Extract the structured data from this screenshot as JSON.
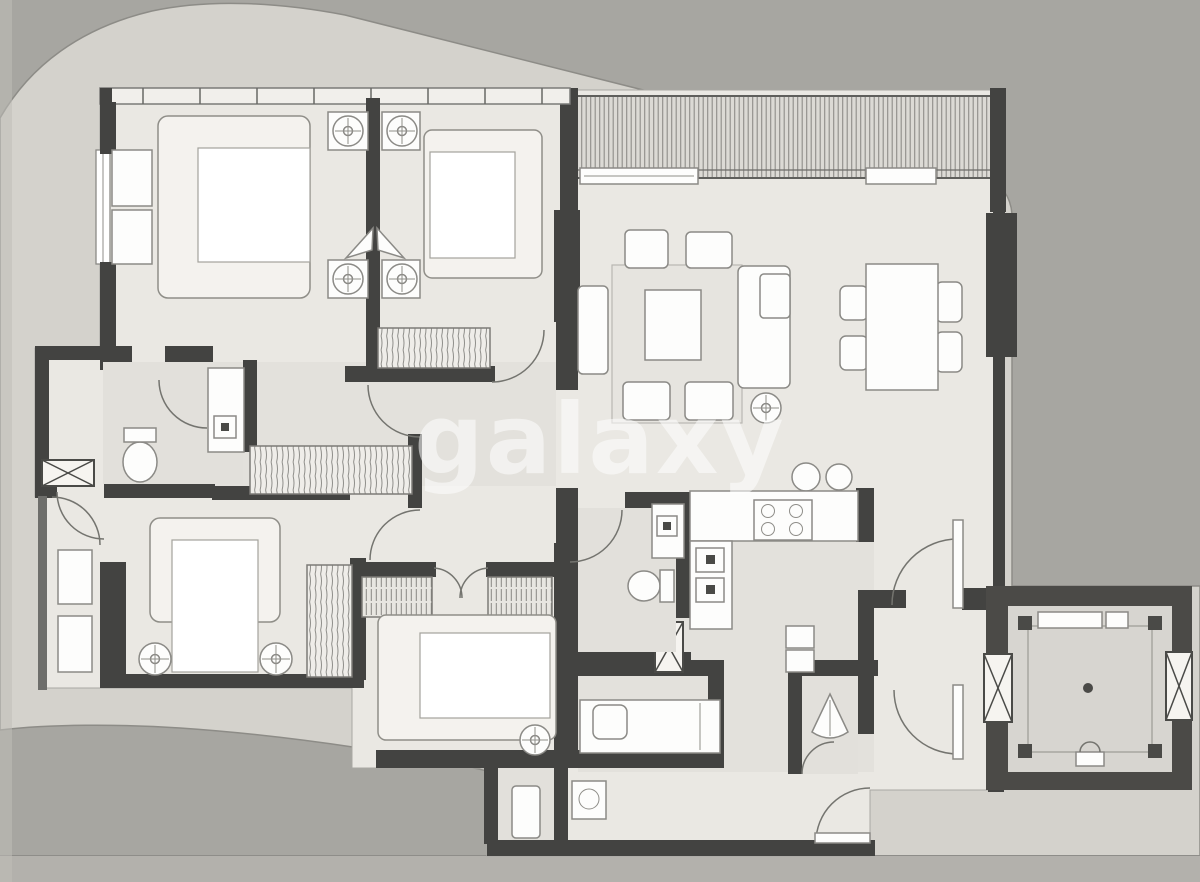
{
  "watermark": {
    "text": "galaxy"
  },
  "palette": {
    "outer_bg": "#a7a6a1",
    "terrace": "#d4d2cc",
    "floor": "#eae8e3",
    "wall": "#434341",
    "wall_soft": "#6e6e6b",
    "white": "#fdfdfc",
    "duvet": "#f4f2ee",
    "line": "#8b8a86",
    "balcony_band": "#dcdad5",
    "elevator_outer": "#4b4a47",
    "elevator_floor": "#d7d5d0",
    "watermark": "#ffffff"
  },
  "plan_features": {
    "type": "apartment-floor-plan",
    "bedrooms": 4,
    "bathrooms": 4,
    "balcony": true,
    "elevator_core": true,
    "dining_chairs": 4,
    "kitchen": true
  }
}
